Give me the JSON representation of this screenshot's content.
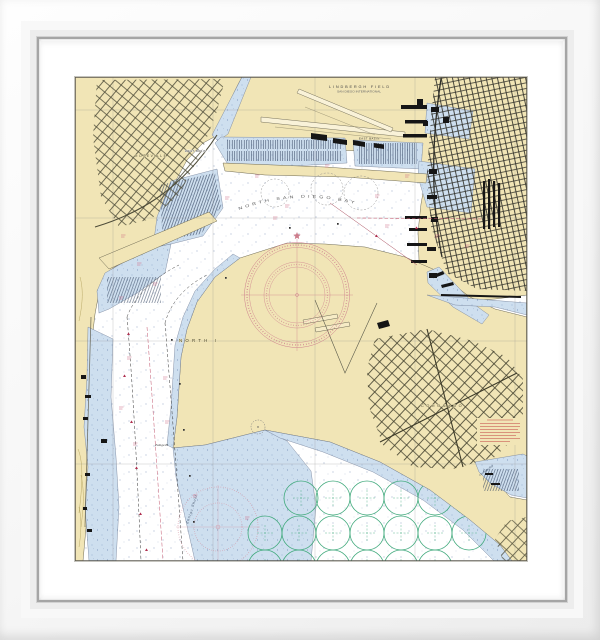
{
  "artwork": {
    "type": "framed nautical chart print"
  },
  "frame": {
    "mat_color": "#ffffff",
    "molding_color": "#f7f7f7",
    "lip_color": "#a5a5a5"
  },
  "chart": {
    "colors": {
      "land": "#f1e5b6",
      "shallow_water": "#cedfef",
      "deep_water": "#ffffff",
      "streets": "#4d4b38",
      "buildings": "#161616",
      "compass_rose": "#cd7d8c",
      "anchorage": "#3fa97b",
      "note_red": "#c24040",
      "magenta": "#c2566e",
      "graticule": "#8c8c8c"
    },
    "labels": {
      "airport": "LINDBERGH FIELD",
      "airport_sub": "SAN DIEGO INTERNATIONAL",
      "bay": "NORTH SAN DIEGO BAY",
      "north_island": "NORTH I",
      "roseville": "ROSEVILLE",
      "coronado": "CORONADO",
      "west_basin": "WEST BASIN",
      "east_basin": "EAST BASIN",
      "zuniga_point": "Zuniga Pt",
      "zuniga_shoal": "Zuniga Shoal",
      "glorietta_bay": "Glorietta Bay"
    }
  }
}
